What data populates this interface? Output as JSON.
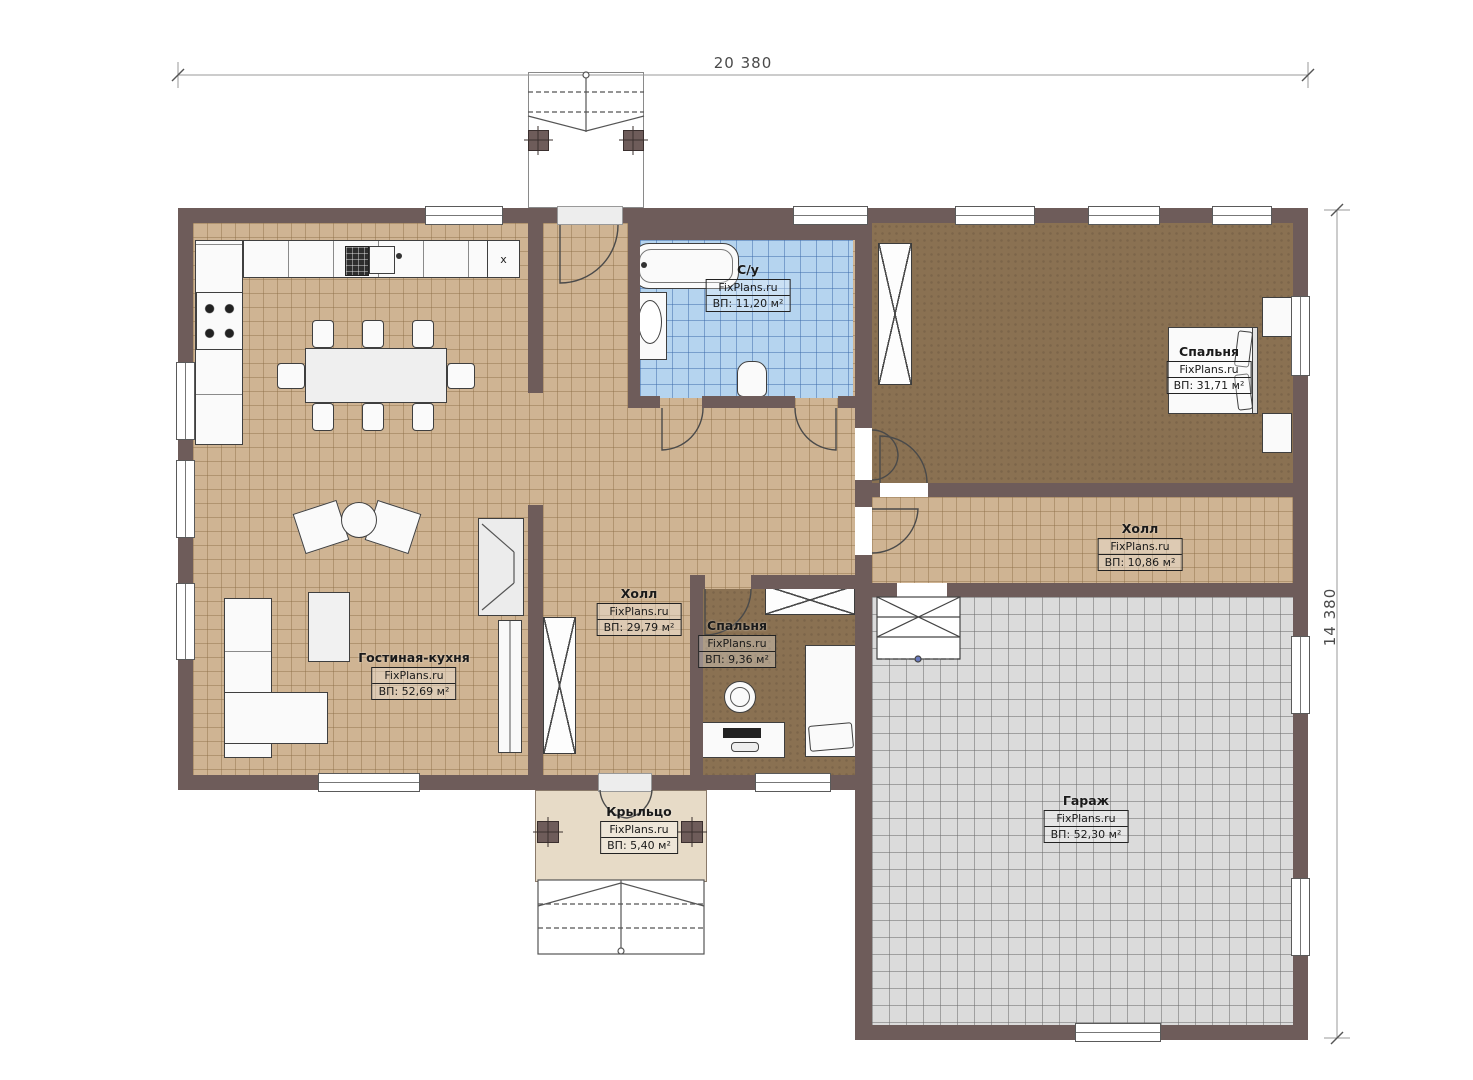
{
  "dimensions": {
    "width": "20 380",
    "height": "14 380"
  },
  "rooms": {
    "bathroom": {
      "name": "С/у",
      "site": "FixPlans.ru",
      "area": "ВП: 11,20 м²"
    },
    "bedroom_main": {
      "name": "Спальня",
      "site": "FixPlans.ru",
      "area": "ВП: 31,71 м²"
    },
    "hall_small": {
      "name": "Холл",
      "site": "FixPlans.ru",
      "area": "ВП: 10,86 м²"
    },
    "hall_main": {
      "name": "Холл",
      "site": "FixPlans.ru",
      "area": "ВП: 29,79 м²"
    },
    "bedroom_small": {
      "name": "Спальня",
      "site": "FixPlans.ru",
      "area": "ВП: 9,36 м²"
    },
    "living_kitchen": {
      "name": "Гостиная-кухня",
      "site": "FixPlans.ru",
      "area": "ВП: 52,69 м²"
    },
    "porch": {
      "name": "Крыльцо",
      "site": "FixPlans.ru",
      "area": "ВП: 5,40 м²"
    },
    "garage": {
      "name": "Гараж",
      "site": "FixPlans.ru",
      "area": "ВП: 52,30 м²"
    }
  },
  "kitchen": {
    "unit_marker": "x"
  },
  "colors": {
    "wall": "#6e5c5a",
    "tile_tan": "#cfb493",
    "tile_blue": "#b5d4ef",
    "floor_wood": "#8a7152",
    "garage_floor": "#dbdbdb",
    "porch_floor": "#e7dbc7"
  }
}
